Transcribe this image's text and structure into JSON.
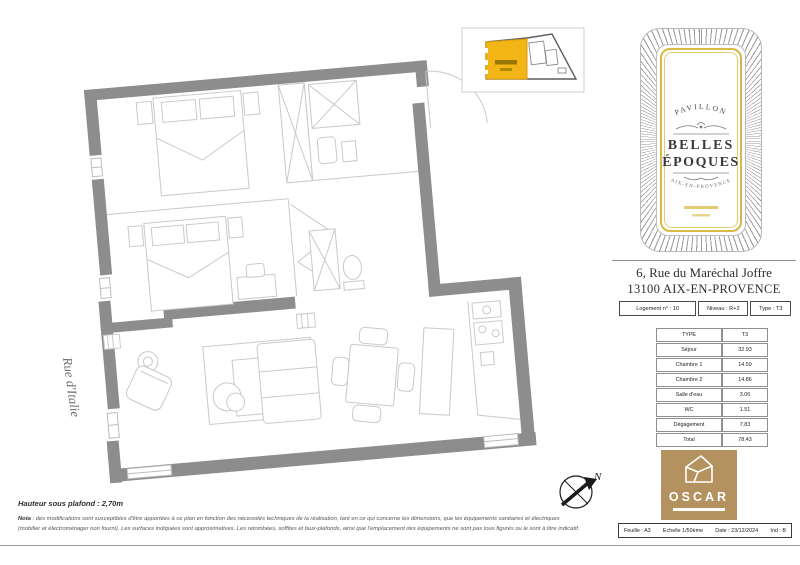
{
  "plan": {
    "street_label": "Rue d'Italie",
    "compass_label": "N"
  },
  "brand_card": {
    "top_arc": "PAVILLON",
    "title_line1": "BELLES",
    "title_line2": "ÉPOQUES",
    "bottom_arc": "AIX-EN-PROVENCE"
  },
  "address": {
    "line1": "6, Rue du Maréchal Joffre",
    "line2": "13100 AIX-EN-PROVENCE"
  },
  "unit_info": {
    "logement": "Logement n° : 10",
    "niveau": "Niveau : R+2",
    "type": "Type : T3"
  },
  "areas": {
    "header": {
      "label": "TYPE",
      "value": "T3"
    },
    "rows": [
      {
        "label": "Séjour",
        "value": "32.93"
      },
      {
        "label": "Chambre 1",
        "value": "14.59"
      },
      {
        "label": "Chambre 2",
        "value": "14.86"
      },
      {
        "label": "Salle d'eau",
        "value": "3.06"
      },
      {
        "label": "WC",
        "value": "1.51"
      },
      {
        "label": "Dégagement",
        "value": "7.83"
      },
      {
        "label": "Total",
        "value": "78.43"
      }
    ]
  },
  "logo": {
    "name": "OSCAR"
  },
  "title_block": {
    "feuille": "Feuille : A3",
    "echelle": "Echelle 1/50ème",
    "date": "Date : 23/12/2024",
    "ind": "Ind : B"
  },
  "notes": {
    "hauteur": "Hauteur sous plafond : 2,70m",
    "nota_label": "Nota",
    "nota_line1": " : des modifications sont susceptibles d'être apportées à ce plan en fonction des nécessités techniques de la réalisation,  tant en ce qui concerne les dimensions, que les équipements sanitaires et électriques",
    "nota_line2": "(mobilier et électroménager non fourni). Les surfaces indiquées sont approximatives. Les retombées, soffites et faux-plafonds, ainsi que l'emplacement des équipements ne sont pas tous figurés ou le sont à titre indicatif."
  },
  "colors": {
    "wall_gray": "#8d8d8d",
    "furniture_gray": "#c9c9c9",
    "keyplan_yellow": "#f3b515",
    "card_gold": "#d9b945",
    "oscar_gold": "#b3925f"
  }
}
